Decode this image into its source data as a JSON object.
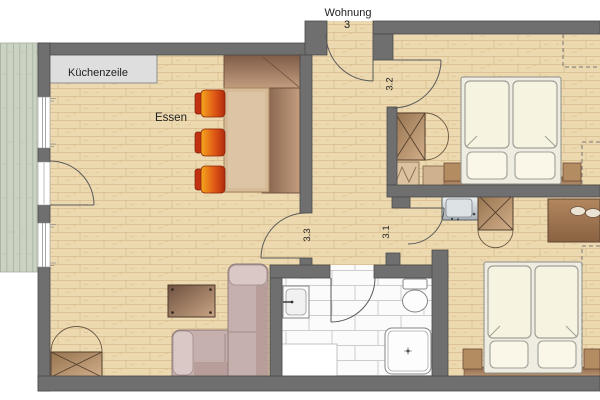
{
  "floorplan": {
    "apartment": {
      "name_line1": "Wohnung",
      "name_line2": "3"
    },
    "labels": {
      "kitchen_unit": "Küchenzeile",
      "dining_area": "Essen"
    },
    "door_numbers": {
      "top_bedroom": "3.2",
      "living_room": "3.3",
      "bottom_bedroom": "3.1"
    },
    "colors": {
      "wall": "#6f6f6f",
      "parquet_floor": "#ecd9b0",
      "bathroom_tile": "#fbfbfb",
      "balcony_deck": "#cbd2c4",
      "kitchen_unit_gray": "#dedede",
      "chair_orange": "#e05a15",
      "wood_furniture": "#96744f",
      "sofa_upholstery": "#c6b0ad"
    }
  }
}
